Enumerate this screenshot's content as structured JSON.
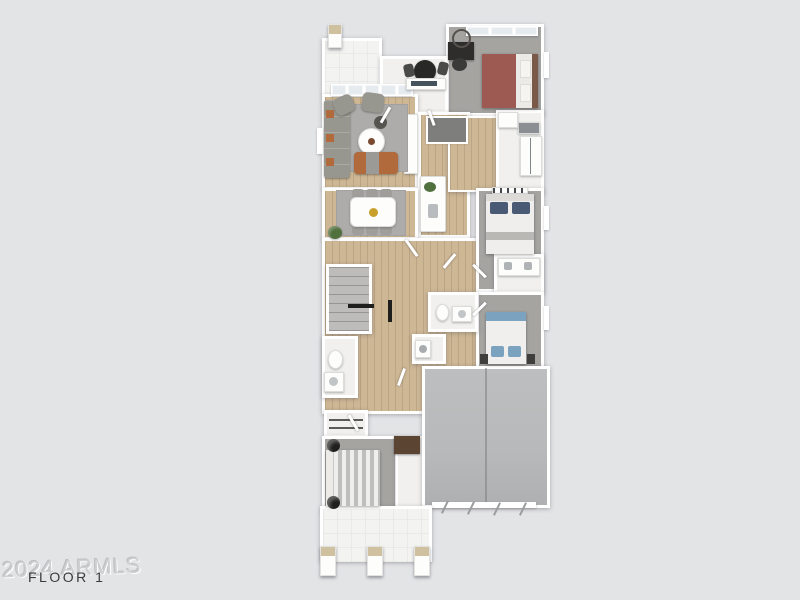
{
  "labels": {
    "floor": "FLOOR 1",
    "watermark": "2024 ARMLS"
  },
  "colors": {
    "bg": "#e3e4e6",
    "wall": "#ffffff",
    "wood": "#cdb795",
    "tile": "#f1f0ee",
    "carpet": "#a5a4a1",
    "rug": "#adacaa",
    "garage": "#b7b9ba",
    "pantry": "#7e7e7c",
    "sofa": "#97968f",
    "bed-red": "#9c5a53",
    "bed-blue": "#7ba3c0",
    "headboard-brown": "#7a5948",
    "accent-orange": "#b06a3c",
    "furniture-black": "#2e2d2b",
    "dresser-brown": "#5b4532",
    "plant": "#50703e",
    "gold": "#c9a02c",
    "stone": "#cfc0a0",
    "label-text": "#3b3b3b",
    "watermark-text": "#cfd0d2"
  },
  "scene": {
    "type": "3d-floor-plan-top-view",
    "rooms": [
      "front-porch",
      "entry-den",
      "guest-bedroom",
      "guest-bathroom",
      "living-room",
      "kitchen",
      "pantry",
      "dining-area",
      "hallway",
      "stairs",
      "powder-bath",
      "laundry",
      "bedroom-2",
      "bathroom-2",
      "bedroom-3",
      "hall-bathroom",
      "primary-bedroom",
      "closet",
      "garage",
      "back-porch"
    ],
    "furniture": [
      "porch-pillar",
      "desk",
      "desk-chair",
      "round-mirror",
      "bed-red",
      "bistro-table",
      "wet-bar-counter",
      "sectional-sofa",
      "armchair",
      "coffee-table",
      "side-table",
      "ottoman-bench",
      "kitchen-island",
      "island-plant",
      "island-sink",
      "dining-table",
      "dining-chair",
      "centerpiece",
      "potted-plant",
      "bed-white",
      "console",
      "dual-vanity",
      "bed-blue",
      "toilet",
      "vanity",
      "washer",
      "stair-railing",
      "bed-gray",
      "nightstand",
      "dresser",
      "closet-rod",
      "garage-door-track"
    ]
  }
}
